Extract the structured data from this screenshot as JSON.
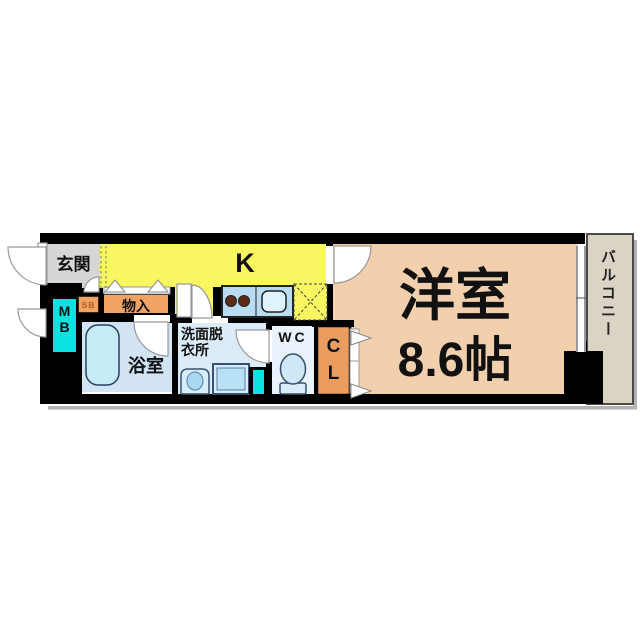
{
  "plan": {
    "genkan": "玄関",
    "kitchen": "K",
    "storage": "物入",
    "shoe_box": "SB",
    "meter_box": [
      "M",
      "B"
    ],
    "bathroom": "浴室",
    "washroom": "洗面脱衣所",
    "toilet": "WC",
    "closet": [
      "C",
      "L"
    ],
    "main_room": "洋室",
    "main_room_size": "8.6帖",
    "balcony": "バルコニー"
  },
  "colors": {
    "wall": "#000000",
    "kitchen_floor": "#f8f661",
    "genkan_floor": "#d6d6d8",
    "main_room_floor": "#f2cfad",
    "balcony_floor": "#dbd4c5",
    "bathroom_floor": "#d2e3f4",
    "washroom_floor": "#dcebf8",
    "wc_floor": "#eaf3fb",
    "storage_orange": "#f0a365",
    "closet_orange": "#ec9c5e",
    "meter_box_cyan": "#0ae2e2",
    "fixture_blue": "#c6ecf8",
    "counter_blue": "#b9dcf0",
    "burner_brown": "#5c2b15"
  }
}
